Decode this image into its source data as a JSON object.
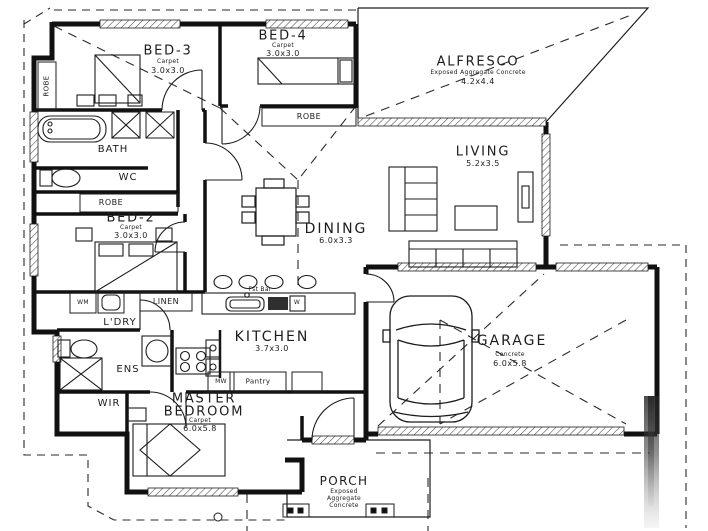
{
  "colors": {
    "ink": "#1c1c1c",
    "paper": "#ffffff"
  },
  "plan": {
    "rooms": {
      "bed3": {
        "name": "BED-3",
        "finish": "Carpet",
        "size": "3.0x3.0"
      },
      "bed4": {
        "name": "BED-4",
        "finish": "Carpet",
        "size": "3.0x3.0"
      },
      "bed2": {
        "name": "BED-2",
        "finish": "Carpet",
        "size": "3.0x3.0"
      },
      "master_bedroom": {
        "name_line1": "MASTER",
        "name_line2": "BEDROOM",
        "finish": "Carpet",
        "size": "6.0x5.8"
      },
      "alfresco": {
        "name": "ALFRESCO",
        "finish": "Exposed Aggregate Concrete",
        "size": "4.2x4.4"
      },
      "living": {
        "name": "LIVING",
        "size": "5.2x3.5"
      },
      "dining": {
        "name": "DINING",
        "size": "6.0x3.3"
      },
      "kitchen": {
        "name": "KITCHEN",
        "size": "3.7x3.0"
      },
      "garage": {
        "name": "GARAGE",
        "finish": "Concrete",
        "size": "6.0x5.8"
      },
      "porch": {
        "name": "PORCH",
        "finish_line1": "Exposed",
        "finish_line2": "Aggregate",
        "finish_line3": "Concrete"
      },
      "bath": {
        "name": "BATH"
      },
      "wc": {
        "name": "WC"
      },
      "ens": {
        "name": "ENS"
      },
      "wir": {
        "name": "WIR"
      },
      "laundry": {
        "name": "L'DRY"
      }
    },
    "fixtures": {
      "robe_bed3": "ROBE",
      "robe_bed2": "ROBE",
      "robe_bed4": "ROBE",
      "linen": "LINEN",
      "washing_machine": "WM",
      "microwave": "MW",
      "pantry": "Pantry",
      "breakfast_bar": "Fst Bar",
      "dishwasher": "W"
    }
  }
}
